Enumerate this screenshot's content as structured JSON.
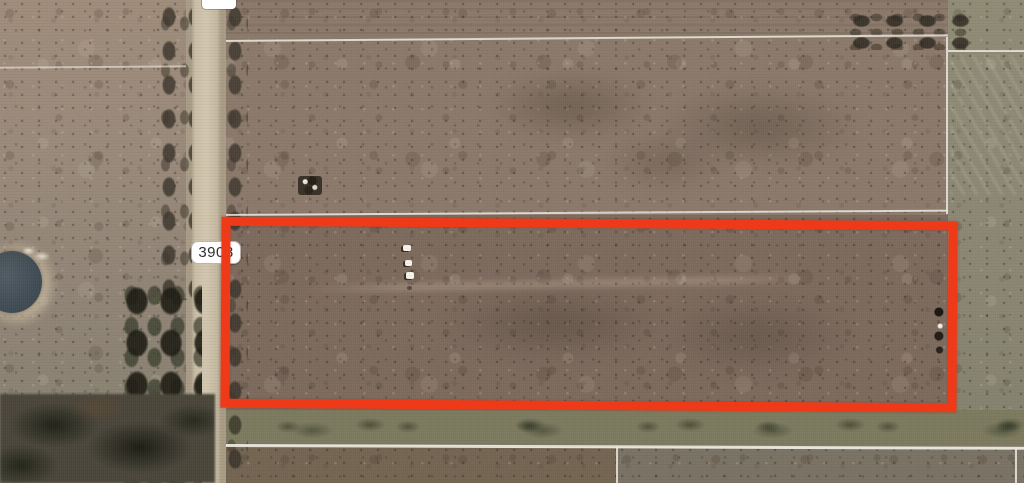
{
  "map": {
    "kind": "satellite-aerial-parcel-view",
    "road_marker": {
      "label": "3908"
    },
    "subject_boundary": {
      "color": "#ef3a19",
      "shape": "rectangle"
    },
    "parcel_line_color": "#ece9e0",
    "terrain": {
      "upper_field": "#8b7a6b",
      "subject_field": "#7d6a5d",
      "left_field": "#99897a",
      "right_field": "#8a8673",
      "road": "#cdc1a9",
      "pond": "#46515a",
      "trees": "#2c2e23",
      "grass_strip": "#7c7a5e",
      "bottom_field": "#746552"
    }
  }
}
